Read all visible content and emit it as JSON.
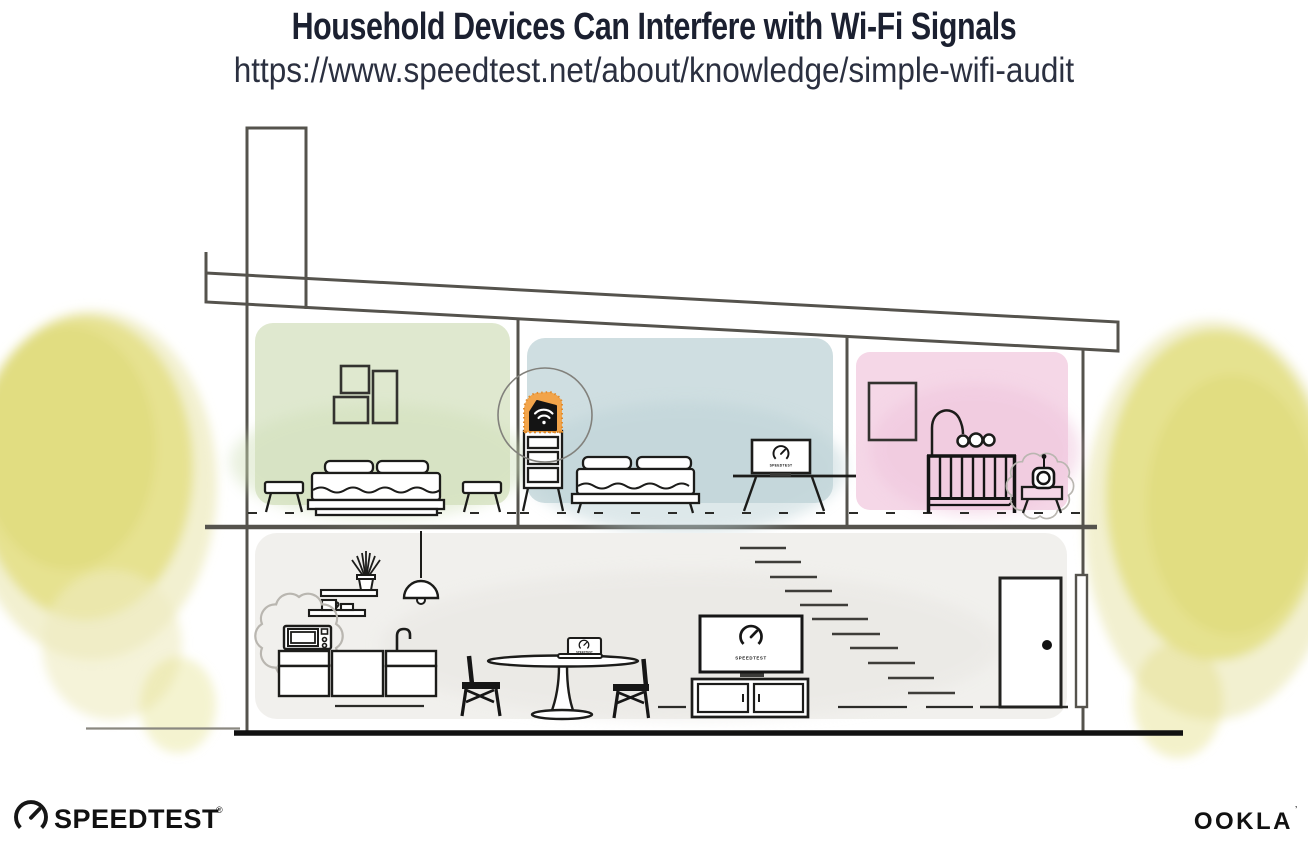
{
  "header": {
    "title": "Household Devices Can Interfere with Wi-Fi Signals",
    "url": "https://www.speedtest.net/about/knowledge/simple-wifi-audit"
  },
  "devices": {
    "screen_label": "SPEEDTEST"
  },
  "footer": {
    "speedtest_logo": "SPEEDTEST",
    "speedtest_reg": "®",
    "ookla_logo": "OOKLA",
    "ookla_mark": "’"
  },
  "colors": {
    "accent-orange": "#F2A44A",
    "accent-orange-edge": "#E08B2D",
    "room-green": "#DFE8CF",
    "room-green-shade": "#CFDFB7",
    "room-blue": "#CFDEE1",
    "room-blue-shade": "#BCD2D6",
    "room-pink": "#F5D7E7",
    "room-pink-shade": "#EEC3DB",
    "room-gray": "#F1F0ED",
    "room-gray-shade": "#E7E5E1",
    "tree-yellow": "#E4E18A",
    "tree-yellow-halo": "#EEEBC0",
    "tree-yellow-dark": "#DCD76E",
    "structure-line": "#55534D",
    "ink": "#1C1C1A",
    "title-color": "#1B2030"
  }
}
